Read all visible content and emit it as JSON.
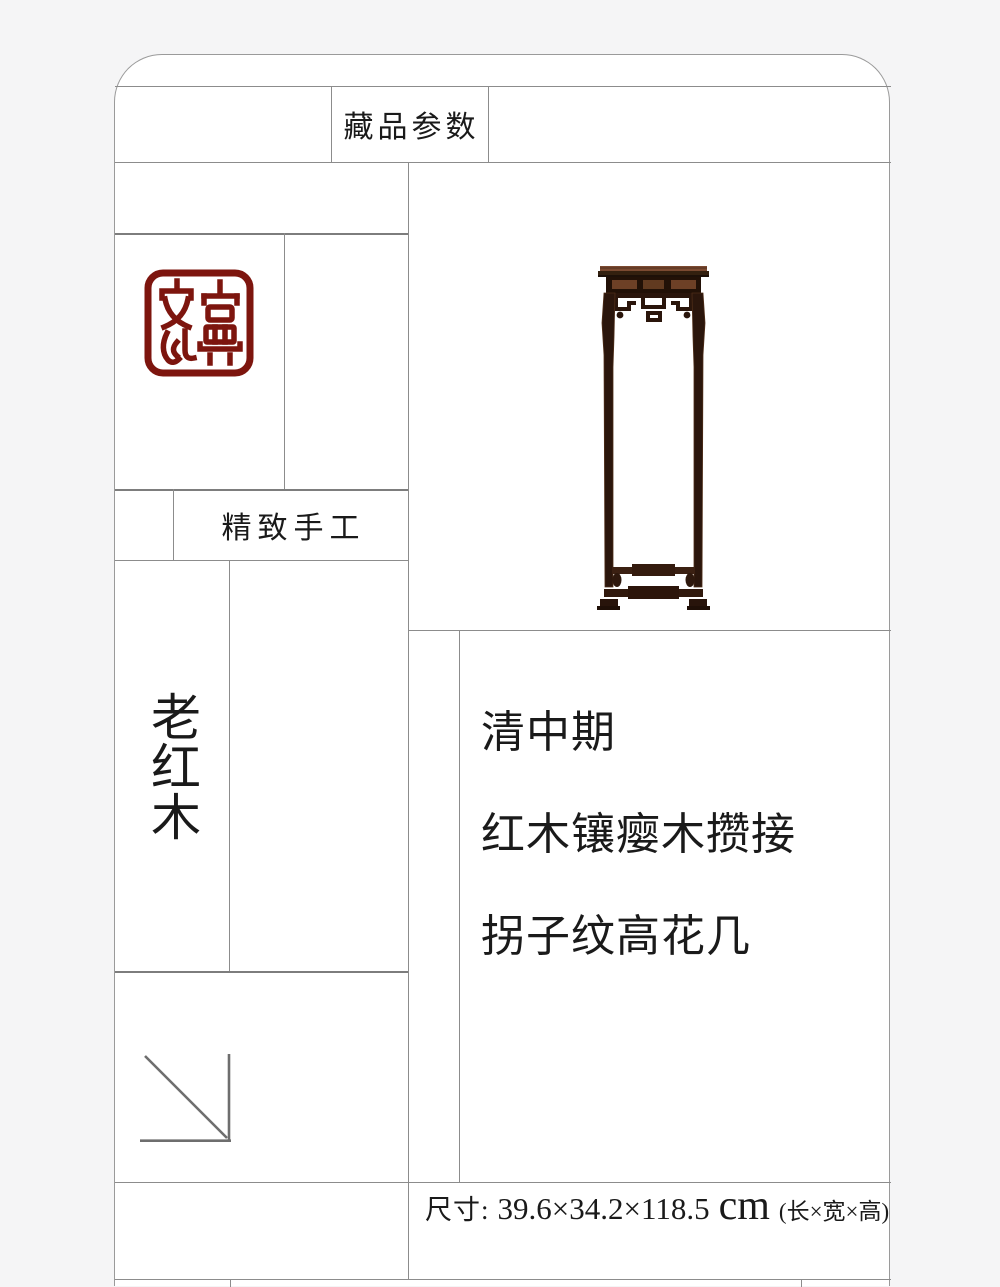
{
  "colors": {
    "page_bg": "#f5f5f6",
    "card_bg": "#ffffff",
    "grid_line": "#8c8c8c",
    "text": "#1a1a1a",
    "seal_red": "#7d150e",
    "wood_dark": "#2b160c",
    "wood_top": "#7b4a31",
    "arrow_gray": "#6e6e6e"
  },
  "header": {
    "collection_params_label": "藏品参数"
  },
  "seal": {
    "text": "古典文化"
  },
  "labels": {
    "craftsmanship": "精致手工",
    "material_vertical": "老红木"
  },
  "product": {
    "era": "清中期",
    "material_desc": "红木镶瘿木攒接",
    "product_name": "拐子纹高花几"
  },
  "dimensions": {
    "label": "尺寸:",
    "value": "39.6×34.2×118.5",
    "unit": "cm",
    "note": "(长×宽×高)"
  }
}
